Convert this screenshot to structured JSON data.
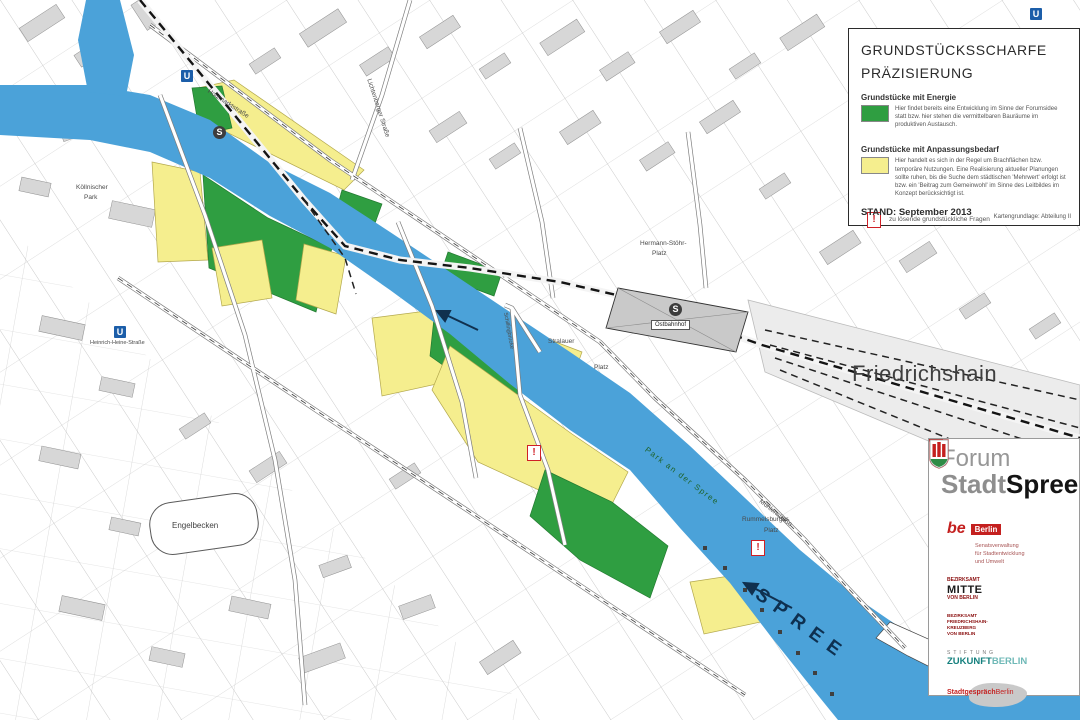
{
  "colors": {
    "river_blue": "#4ba2d9",
    "energy_green": "#2f9e41",
    "adaptation_yellow": "#f5ee8e",
    "alert_red": "#cf2026"
  },
  "legend": {
    "title_line1": "GRUNDSTÜCKSSCHARFE",
    "title_line2": "PRÄZISIERUNG",
    "entries": [
      {
        "heading": "Grundstücke mit Energie",
        "text": "Hier findet bereits eine Entwicklung im Sinne der Forumsidee statt bzw. hier stehen die vermittelbaren Bauräume im produktiven Austausch."
      },
      {
        "heading": "Grundstücke mit Anpassungsbedarf",
        "text": "Hier handelt es sich in der Regel um Brachflächen bzw. temporäre Nutzungen. Eine Realisierung aktueller Planungen sollte ruhen, bis die Suche dem städtischen 'Mehrwert' erfolgt ist bzw. ein 'Beitrag zum Gemeinwohl' im Sinne des Leitbildes im Konzept berücksichtigt ist."
      }
    ],
    "alert_symbol": "!",
    "alert_note": "zu lösende grundstückliche Fragen",
    "stand": "STAND: September 2013",
    "source": "Kartengrundlage: Abteilung II"
  },
  "forum": {
    "title_line1": "Forum",
    "title_stadt": "Stadt",
    "title_spree": "Spree",
    "be_berlin": {
      "be": "be",
      "berlin": "Berlin",
      "sub1": "Senatsverwaltung",
      "sub2": "für Stadtentwicklung",
      "sub3": "und Umwelt"
    },
    "mitte": {
      "l1": "BEZIRKSAMT",
      "l2": "MITTE",
      "l3": "VON BERLIN"
    },
    "friedrichshain_kreuzberg": {
      "l1": "BEZIRKSAMT",
      "l2": "FRIEDRICHSHAIN-",
      "l3": "KREUZBERG",
      "l4": "VON BERLIN"
    },
    "stiftung": {
      "l1": "STIFTUNG",
      "l2a": "ZUKUNFT",
      "l2b": "BERLIN"
    },
    "stadtgespraech": {
      "a": "Stadtgespräch",
      "b": "Berlin"
    }
  },
  "map": {
    "district": "Friedrichshain",
    "river": "SPREE",
    "park": "Park an der Spree",
    "station_ostbahnhof": "Ostbahnhof",
    "hermann_stoehr_1": "Hermann-Stöhr-",
    "hermann_stoehr_2": "Platz",
    "rummelsburger_1": "Rummelsburger",
    "rummelsburger_2": "Platz",
    "engelbecken": "Engelbecken",
    "koellnischer_1": "Köllnischer",
    "koellnischer_2": "Park",
    "heinrich_heine": "Heinrich-Heine-Straße",
    "holzmarktstrasse": "Holzmarktstraße",
    "lichtenberger": "Lichtenberger Straße",
    "stralauer_1": "Stralauer",
    "stralauer_2": "Platz",
    "muehlenstrasse": "Mühlenstraße",
    "schillingbruecke": "Schillingbrücke",
    "u_symbol": "U",
    "s_symbol": "S"
  }
}
